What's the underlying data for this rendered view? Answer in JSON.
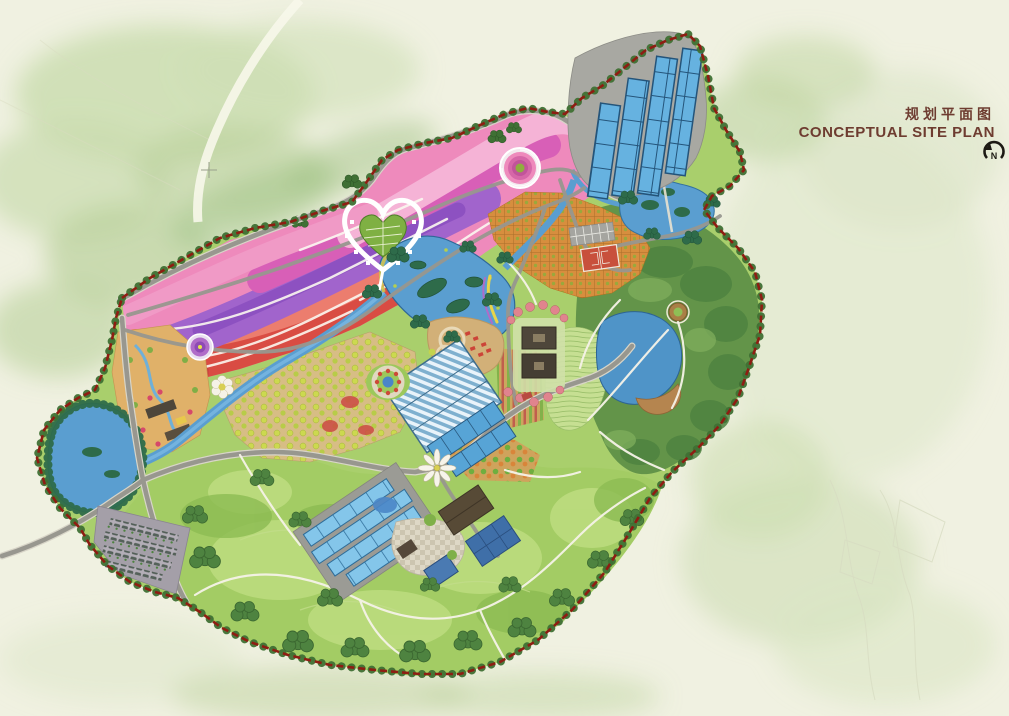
{
  "header": {
    "title_cn": "规划平面图",
    "title_en": "CONCEPTUAL SITE PLAN"
  },
  "compass": {
    "north_label": "N"
  },
  "colors": {
    "paper": "#f0f1e1",
    "context_wash": "#c9dcae",
    "boundary_red": "#8e1d12",
    "boundary_trees": "#3f7034",
    "site_base": "#a9cf6c",
    "pasture": "#a3cc64",
    "pasture_light": "#bcdc7e",
    "forest": "#639449",
    "tree_dark": "#4e8340",
    "water": "#5a9ed0",
    "water_deep": "#2f6898",
    "wetland": "#2e6b4a",
    "flower_base": "#ee8abc",
    "flower_red": "#d94c43",
    "flower_salmon": "#ec7d6e",
    "flower_pink_light": "#f5b3d6",
    "flower_magenta": "#d85fb7",
    "flower_purple": "#a164cc",
    "flower_violet": "#8b4fc0",
    "heart_green": "#7fb043",
    "orchard_orange": "#d78e3e",
    "orchard_tan": "#d7bd85",
    "tan_garden": "#e0b169",
    "greenhouse_blue": "#66b2e0",
    "greenhouse_light": "#84c6ea",
    "roof_blue": "#3f6fa8",
    "roof_brown": "#574a36",
    "roof_dark": "#4e463a",
    "court_red": "#c8503c",
    "road": "#98978f",
    "path_white": "#f6f3e8",
    "plaza_tan": "#d2b078",
    "parking": "#a49fa8",
    "blossom": "#e0848e",
    "title": "#6e3c30",
    "compass_ink": "#1d1a14"
  },
  "features": [
    "site-boundary",
    "boundary-tree-line",
    "flower-terraced-fields",
    "heart-garden",
    "spiral-plaza",
    "round-plaza",
    "petal-plaza",
    "mandala-garden",
    "windmill-plaza",
    "central-lake",
    "lake-islands",
    "west-wetland-lake",
    "east-hill-lake",
    "northeast-ponds",
    "stream",
    "north-greenhouses",
    "central-glasshouse",
    "central-blue-greenhouses",
    "south-greenhouses",
    "farm-buildings",
    "checker-plaza",
    "courtyard-buildings",
    "blossom-trees",
    "sports-courts",
    "north-parking",
    "west-parking-lot",
    "orchard-grid",
    "yellow-dot-orchard",
    "row-crop-fields",
    "tan-herb-garden",
    "farmstead-buildings",
    "pasture-hills",
    "tree-clumps",
    "east-forest",
    "contour-terraces",
    "round-lookout",
    "waterfront-plaza",
    "main-roads",
    "walking-paths",
    "survey-crosshair"
  ]
}
